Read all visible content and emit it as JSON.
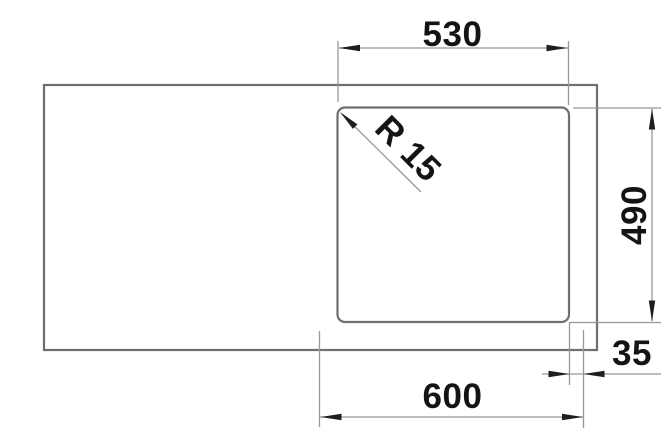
{
  "drawing": {
    "background": "#ffffff",
    "colors": {
      "outline": "#6f6f6f",
      "dimension_line": "#979797",
      "arrow": "#1e1e1e",
      "label": "#141414"
    },
    "labels": {
      "cutout_width": "530",
      "cutout_depth": "490",
      "sink_width": "600",
      "rim_offset": "35",
      "corner_radius": "R 15"
    }
  }
}
